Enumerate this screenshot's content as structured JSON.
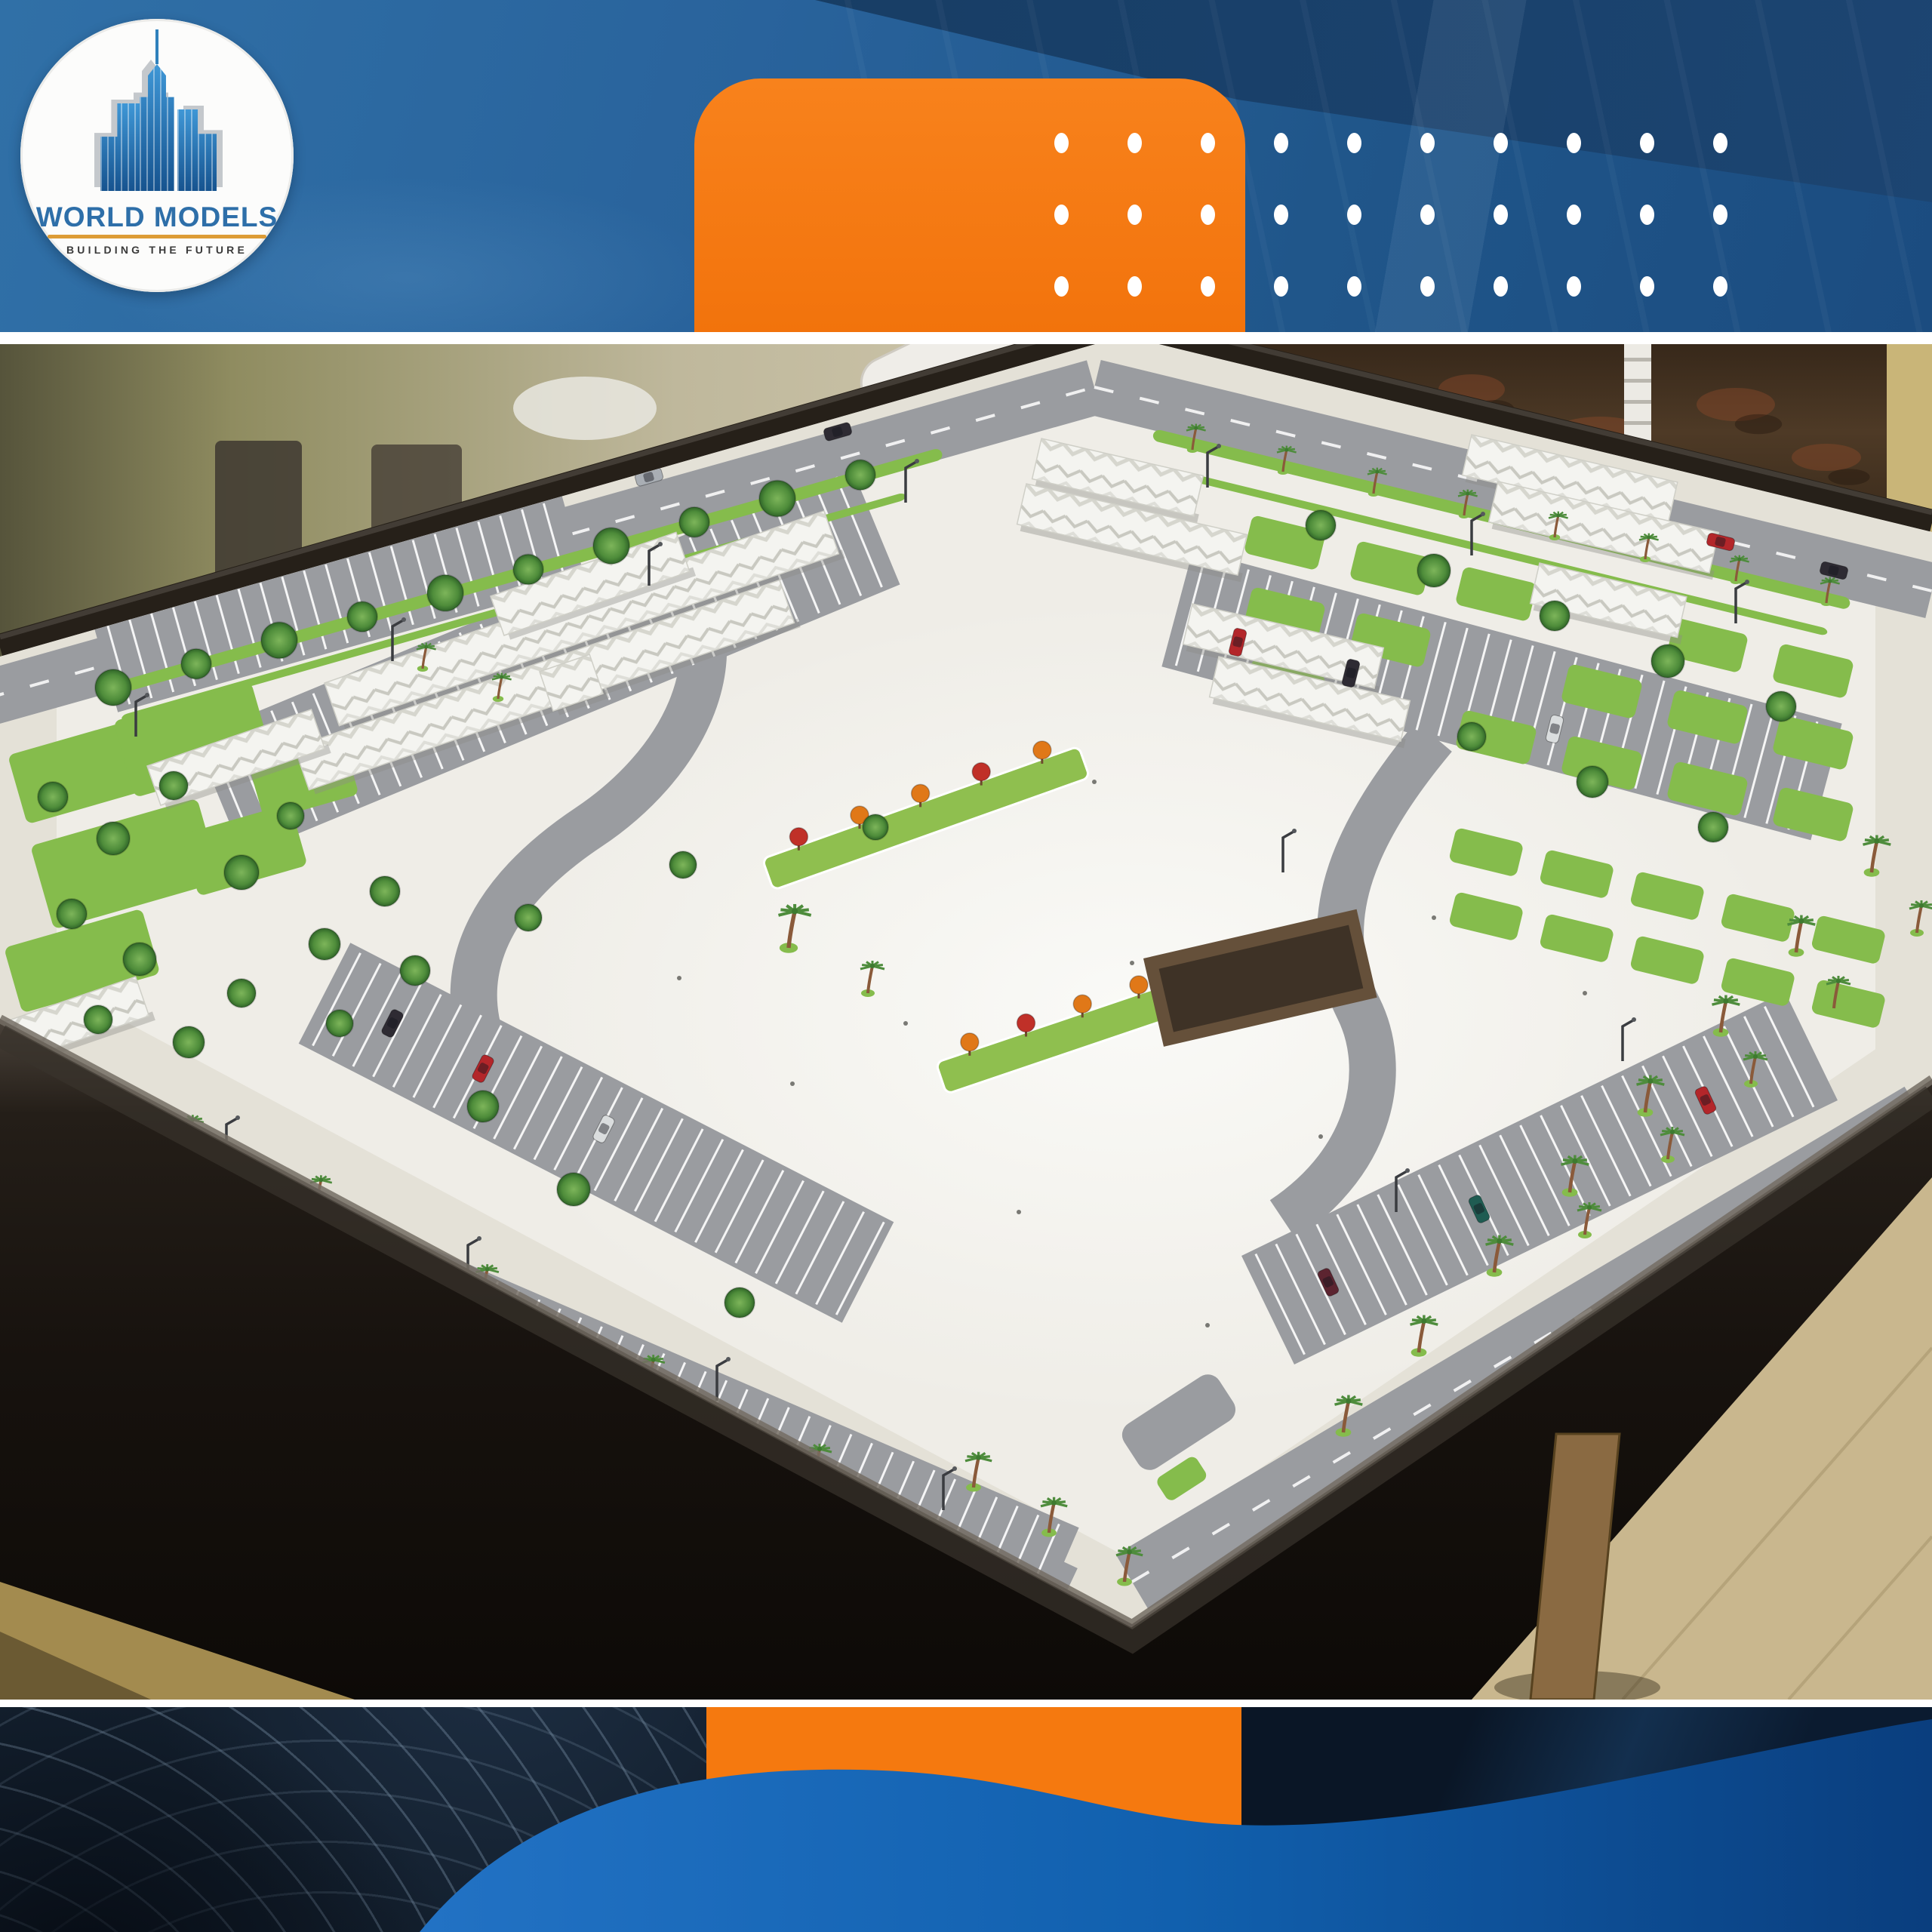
{
  "meta": {
    "type": "marketing poster",
    "description": "Photograph of an architectural scale model of a large parking complex (parking rows, white shade canopies, palm trees, lawns, model cars) displayed on a dark wooden table, framed by a branded blue header band and footer band with orange blocks and white dot pattern"
  },
  "brand": {
    "logo_title": "WORLD MODELS",
    "logo_tagline": "BUILDING THE FUTURE",
    "accent_orange": "#F5790F",
    "brand_blue": "#2E6FA9",
    "underline_gold": "#DD9C36",
    "banner_blue": "#29639C",
    "banner_navy": "#16395F",
    "footer_navy": "#121E2C",
    "footer_wave_blue": "#1160AE",
    "dot_color": "#FFFFFF"
  },
  "decor": {
    "dot_rows": 3,
    "dot_cols": 10
  },
  "photo": {
    "subject": "parking complex scale model on dark table",
    "wall": "#CDC5AA",
    "wall_left": "#8F8C60",
    "tapestry": "#4E3A26",
    "yellow_wall": "#C9B578",
    "board": "#EFEDE7",
    "sidewalk": "#E4E1D7",
    "road": "#9A9CA0",
    "lawn": "#85BC4C",
    "tree_dark": "#2F6428",
    "canopy": "#F4F4F0",
    "palm_trunk": "#8A5A3A",
    "palm_leaf": "#4E8C3C",
    "flower_orange": "#E07818",
    "flower_red": "#C03028",
    "pit_brown": "#65503A",
    "table": "#17120E",
    "floor_right": "#C9B78E",
    "floor_left": "#A38B4F",
    "leg_wood": "#8A6A42",
    "car_colors": [
      "#B3262A",
      "#2E2B33",
      "#DADDDE",
      "#A9AEB4",
      "#5C2430",
      "#1F5C52",
      "#7A1E22"
    ]
  }
}
